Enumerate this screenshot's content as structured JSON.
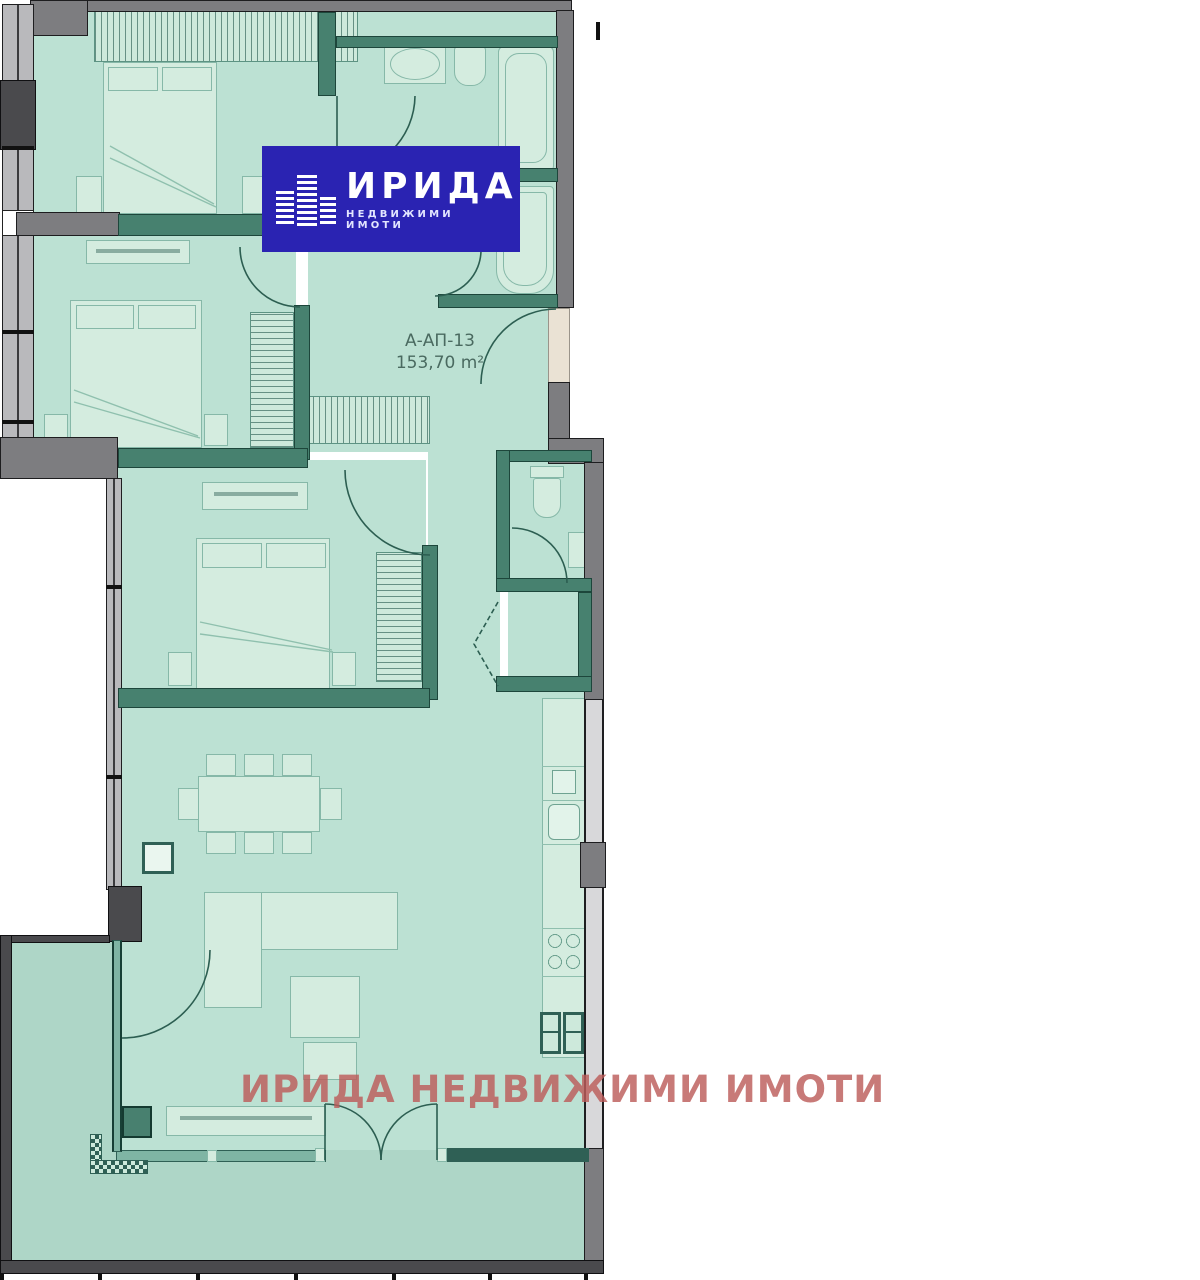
{
  "logo": {
    "title": "ИРИДА",
    "subtitle": "НЕДВИЖИМИ ИМОТИ"
  },
  "apartment": {
    "code": "А-АП-13",
    "area": "153,70 m²"
  },
  "watermark": "ИРИДА НЕДВИЖИМИ ИМОТИ",
  "colors": {
    "room_fill": "#bce1d3",
    "balcony_fill": "#aed6c7",
    "furniture_fill": "#d4ecdf",
    "wall_gray": "#7d7d80",
    "wall_teal": "#47816f",
    "wall_teal_dark": "#2f6055",
    "logo_blue": "#2a23b2",
    "watermark_red": "#bd5d5b",
    "label_text": "#4a6a60"
  }
}
